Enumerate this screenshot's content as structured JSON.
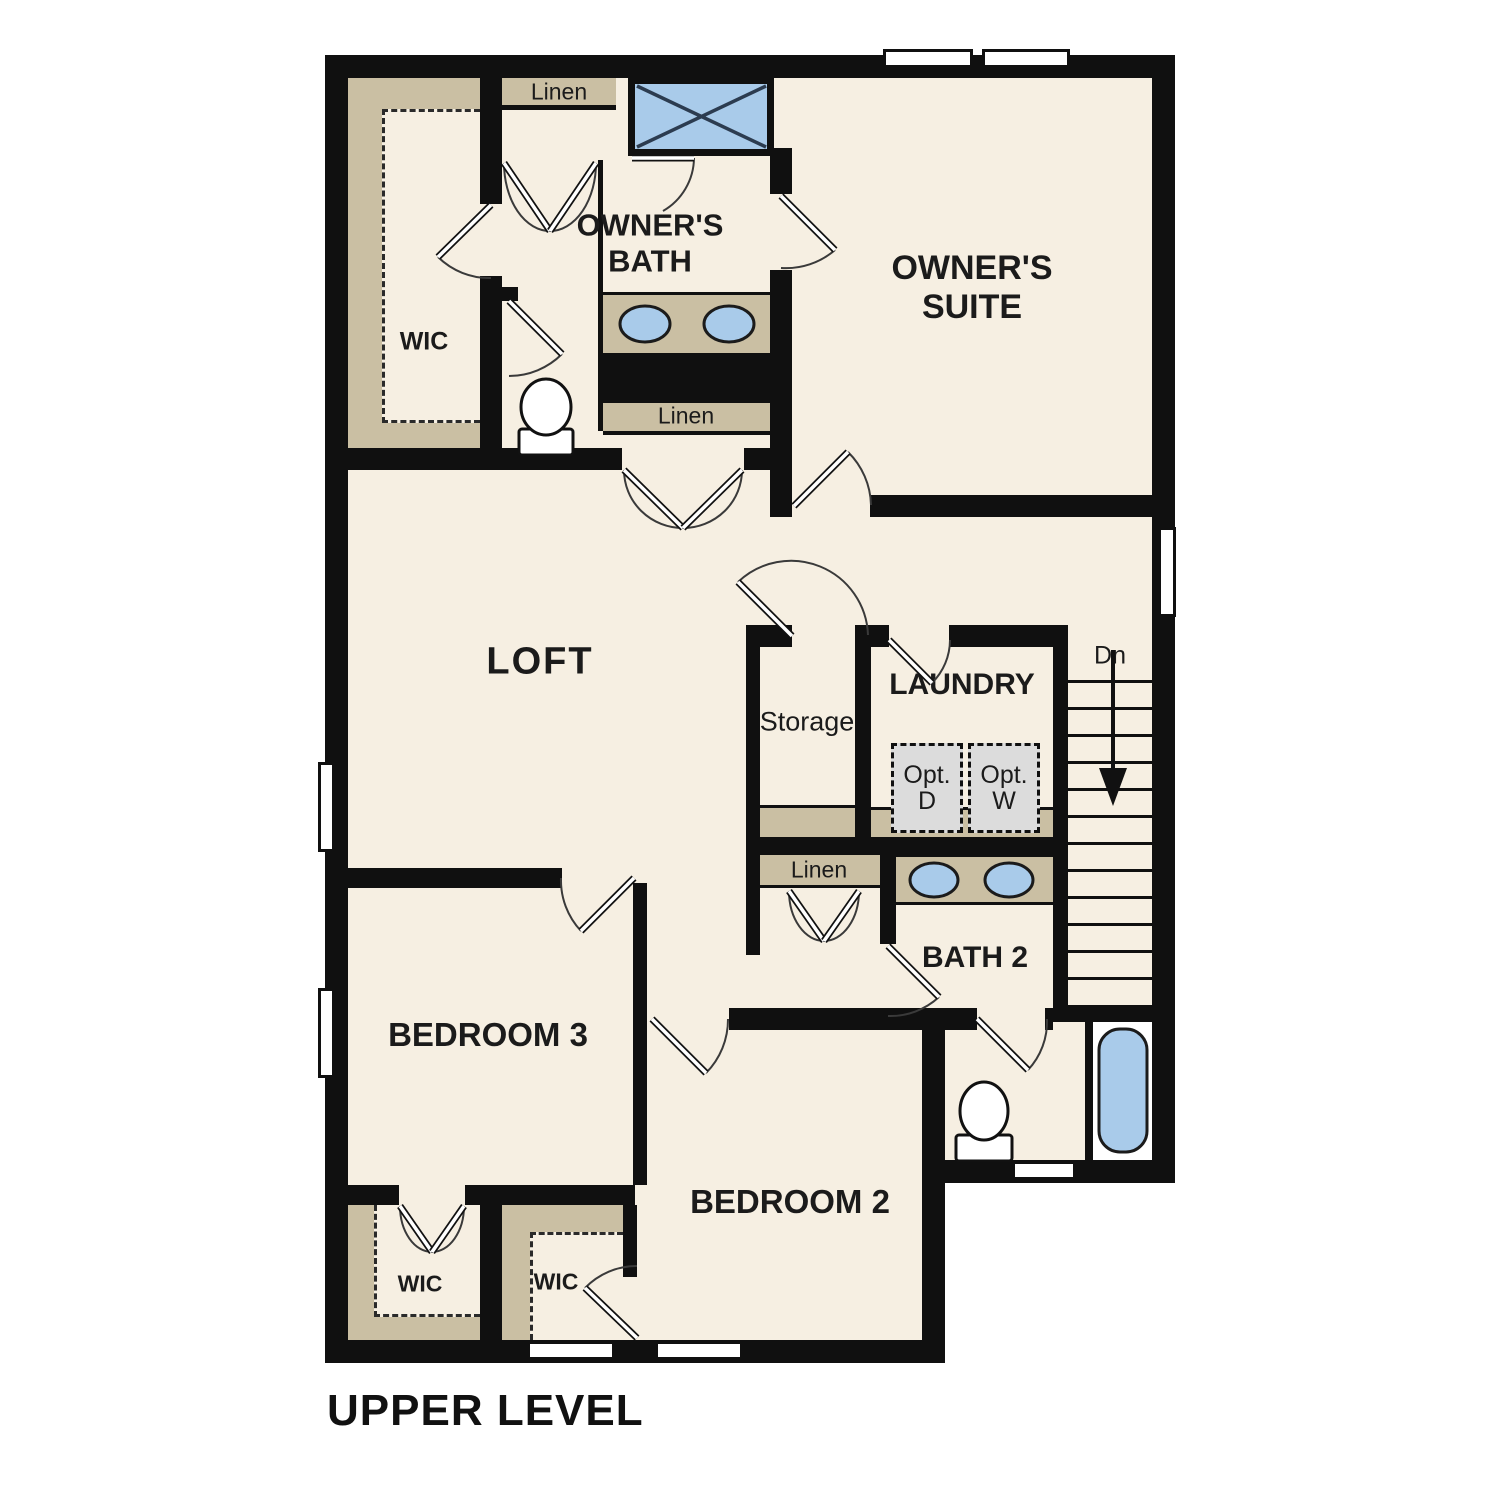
{
  "title": "UPPER LEVEL",
  "colors": {
    "floor": "#f6efe2",
    "shelf_tan": "#cabfa3",
    "fixture_blue": "#a9cbea",
    "wall_black": "#101010",
    "appliance_gray": "#dcdcdc",
    "background": "#ffffff"
  },
  "rooms": {
    "owners_suite": "OWNER'S SUITE",
    "owners_bath": "OWNER'S BATH",
    "loft": "LOFT",
    "laundry": "LAUNDRY",
    "storage": "Storage",
    "bath2": "BATH 2",
    "bedroom2": "BEDROOM 2",
    "bedroom3": "BEDROOM 3"
  },
  "closets": {
    "wic_owners": "WIC",
    "wic_bedroom3": "WIC",
    "wic_bedroom2": "WIC",
    "linen_bath": "Linen",
    "linen_hall": "Linen",
    "linen_loft": "Linen"
  },
  "stairs": {
    "direction_label": "Dn"
  },
  "laundry_options": {
    "dryer": {
      "line1": "Opt.",
      "line2": "D"
    },
    "washer": {
      "line1": "Opt.",
      "line2": "W"
    }
  },
  "fixtures": [
    "shower",
    "owners-bath-double-sink",
    "owners-bath-toilet",
    "bath2-double-sink",
    "bath2-toilet",
    "bathtub",
    "optional-dryer",
    "optional-washer"
  ]
}
